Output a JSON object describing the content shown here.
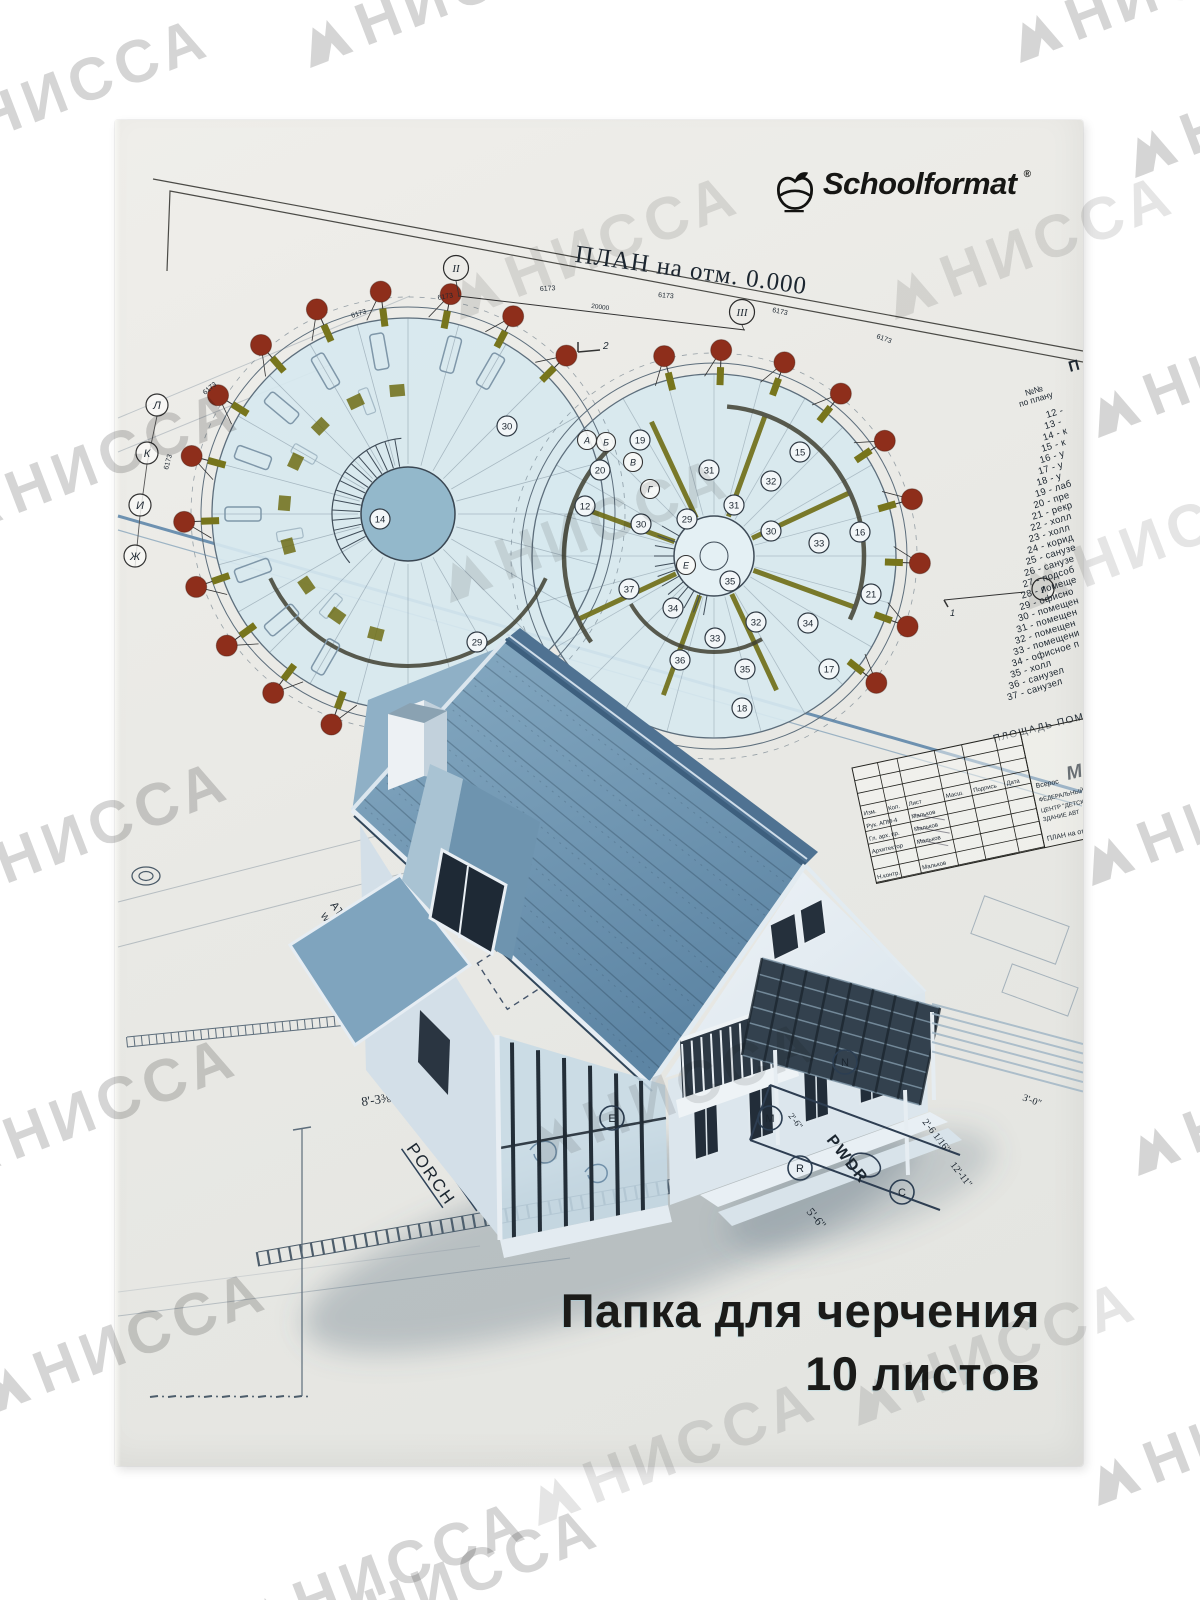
{
  "brand": {
    "name": "Schoolformat",
    "reg": "®"
  },
  "cover": {
    "title_line1": "Папка для черчения",
    "title_line2": "10 листов"
  },
  "watermark": {
    "text": "НИССА"
  },
  "plan": {
    "title": "ПЛАН на отм. 0.000",
    "total_dim": "20000",
    "arc_dim": "6173",
    "axis_top": [
      "II",
      "III"
    ],
    "axis_left": [
      "Л",
      "К",
      "И",
      "Ж"
    ],
    "axis_right": "I",
    "section_flags": [
      "1",
      "2"
    ],
    "grid_letters": [
      "А",
      "Б",
      "В",
      "Г",
      "Е"
    ],
    "room_badges": [
      {
        "t": "14",
        "x": 380,
        "y": 519
      },
      {
        "t": "12",
        "x": 585,
        "y": 506
      },
      {
        "t": "30",
        "x": 507,
        "y": 426
      },
      {
        "t": "30",
        "x": 641,
        "y": 524
      },
      {
        "t": "37",
        "x": 629,
        "y": 589
      },
      {
        "t": "29",
        "x": 477,
        "y": 642
      },
      {
        "t": "15",
        "x": 800,
        "y": 452
      },
      {
        "t": "31",
        "x": 709,
        "y": 470
      },
      {
        "t": "31",
        "x": 734,
        "y": 505
      },
      {
        "t": "32",
        "x": 771,
        "y": 481
      },
      {
        "t": "30",
        "x": 771,
        "y": 531
      },
      {
        "t": "29",
        "x": 687,
        "y": 519
      },
      {
        "t": "33",
        "x": 819,
        "y": 543
      },
      {
        "t": "16",
        "x": 860,
        "y": 532
      },
      {
        "t": "21",
        "x": 871,
        "y": 594
      },
      {
        "t": "34",
        "x": 673,
        "y": 608
      },
      {
        "t": "35",
        "x": 730,
        "y": 581
      },
      {
        "t": "32",
        "x": 756,
        "y": 622
      },
      {
        "t": "34",
        "x": 808,
        "y": 623
      },
      {
        "t": "33",
        "x": 715,
        "y": 638
      },
      {
        "t": "36",
        "x": 680,
        "y": 660
      },
      {
        "t": "35",
        "x": 745,
        "y": 669
      },
      {
        "t": "17",
        "x": 829,
        "y": 669
      },
      {
        "t": "18",
        "x": 742,
        "y": 708
      },
      {
        "t": "19",
        "x": 640,
        "y": 440
      },
      {
        "t": "20",
        "x": 600,
        "y": 470
      }
    ]
  },
  "legend": {
    "header_line1": "№№",
    "header_line2": "по плану",
    "items": [
      {
        "n": "12",
        "label": ""
      },
      {
        "n": "13",
        "label": ""
      },
      {
        "n": "14",
        "label": "к"
      },
      {
        "n": "15",
        "label": "к"
      },
      {
        "n": "16",
        "label": "у"
      },
      {
        "n": "17",
        "label": "у"
      },
      {
        "n": "18",
        "label": "у"
      },
      {
        "n": "19",
        "label": "лаб"
      },
      {
        "n": "20",
        "label": "пре"
      },
      {
        "n": "21",
        "label": "рекр"
      },
      {
        "n": "22",
        "label": "холл"
      },
      {
        "n": "23",
        "label": "холл"
      },
      {
        "n": "24",
        "label": "корид"
      },
      {
        "n": "25",
        "label": "санузе"
      },
      {
        "n": "26",
        "label": "санузе"
      },
      {
        "n": "27",
        "label": "подсоб"
      },
      {
        "n": "28",
        "label": "помеще"
      },
      {
        "n": "29",
        "label": "офисно"
      },
      {
        "n": "30",
        "label": "помещен"
      },
      {
        "n": "31",
        "label": "помещен"
      },
      {
        "n": "32",
        "label": "помещен"
      },
      {
        "n": "33",
        "label": "помещени"
      },
      {
        "n": "34",
        "label": "офисное п"
      },
      {
        "n": "35",
        "label": "холл"
      },
      {
        "n": "36",
        "label": "санузел"
      },
      {
        "n": "37",
        "label": "санузел"
      }
    ]
  },
  "area_caption": "ПЛОЩАДЬ ПОМЕЩЕНИЙ",
  "big_letters": [
    "П",
    "М"
  ],
  "titleblock": {
    "header_cells": [
      "Изм.",
      "Кол.",
      "Лист",
      "Масш.",
      "Подпись",
      "Дата"
    ],
    "rows": [
      [
        "Рук. АПМ-4",
        "Мальков"
      ],
      [
        "Гл. арх. пр.",
        "Мальков"
      ],
      [
        "Архитектор",
        "Мальков"
      ],
      [
        "Н.контр.",
        "Мальков"
      ]
    ],
    "right_lines": [
      "Всерос",
      "ФЕДЕРАЛЬНЫЙ ЭКСП",
      "ЦЕНТР \"ДЕТСКИЙ",
      "ЗДАНИЕ АВТ",
      "ПЛАН на от"
    ]
  },
  "house_plan": {
    "covered_porch_1": "COVERED",
    "covered_porch_2": "PORCH",
    "attic_1": "ATTIC ACCESS",
    "attic_2": "W/ PULL-DOWN LADDER",
    "pwdr": "PWDR",
    "dim_a": "8'-3⅜\"",
    "dim_b": "5'-6\"",
    "dim_c": "2'-6 1/16\"",
    "dim_d": "12'-11\"",
    "dim_e": "3'-0\"",
    "dim_f": "2'-6\"",
    "circle_letters": [
      "E",
      "N",
      "C",
      "M",
      "R"
    ]
  },
  "colors": {
    "accent_red": "#8e2e1b",
    "olive": "#6f6d15",
    "plan_fill": "#d7e8ef",
    "roof": "#6f96b2",
    "line_blue": "#4e7ba2"
  }
}
